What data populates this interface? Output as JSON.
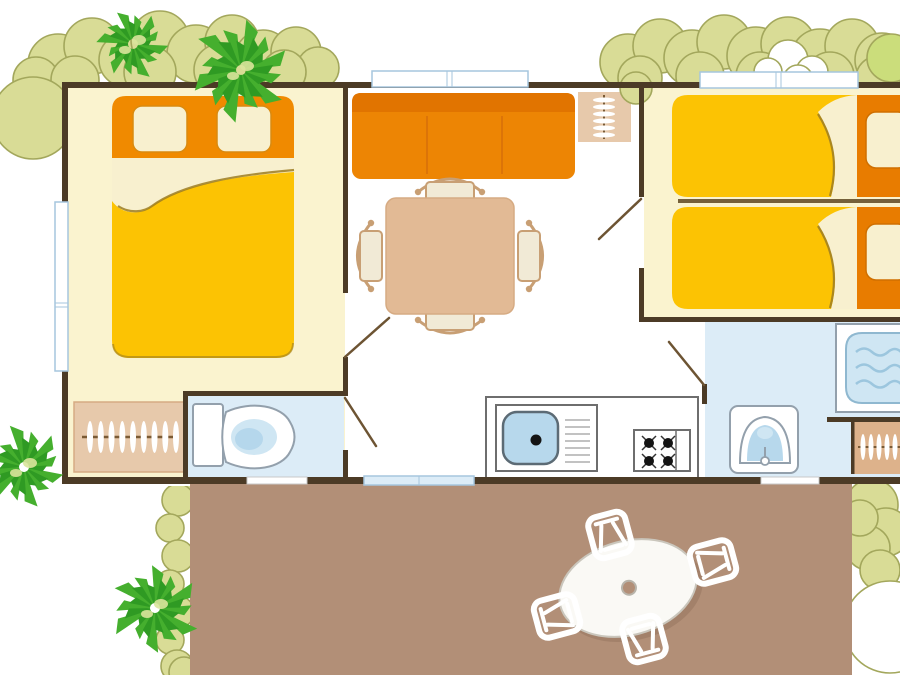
{
  "canvas": {
    "width": 900,
    "height": 675
  },
  "plan": {
    "type": "mobile-home-floorplan",
    "rooms": [
      "bedroom-double",
      "living-kitchen",
      "bedroom-twin",
      "wc",
      "bathroom",
      "terrace"
    ],
    "furniture": [
      "double-bed",
      "wardrobe-hangers",
      "toilet",
      "sofa",
      "coat-rack",
      "dining-table-4-chairs",
      "kitchen-sink",
      "stove-4-burners",
      "single-bed",
      "single-bed",
      "washbasin",
      "shower",
      "wardrobe-hangers",
      "terrace-oval-table",
      "terrace-chair",
      "terrace-chair",
      "terrace-chair",
      "terrace-chair"
    ],
    "windows": 3,
    "doors": 4,
    "vegetation": [
      "bush-top-left",
      "bush-top-right",
      "bush-left-circle",
      "bush-terrace-left",
      "bush-terrace-right",
      "palm-top-left-small",
      "palm-top-left-big",
      "palm-bottom-left",
      "palm-bottom"
    ]
  },
  "palette": {
    "wall": "#4c3b26",
    "door_leaf": "#6d5433",
    "room_cream": "#faf3cf",
    "wet_blue": "#dcecf7",
    "floor_white": "#ffffff",
    "terrace": "#b28f77",
    "bed_yellow": "#fcc303",
    "headboard_orange": "#f08a00",
    "headboard_orange_dark": "#e87c00",
    "pillow_stroke": "#d98a10",
    "fold_cream": "#f8f0cf",
    "fold_shadow": "#9c7d22",
    "sofa": "#ed8504",
    "sofa_back": "#e17400",
    "sofa_seam": "#d8700a",
    "wood_tan": "#e2ba95",
    "wood_tan_edge": "#d6ab83",
    "wood_light": "#e7c9ab",
    "wardrobe_tan": "#ddb28b",
    "rail_brown": "#7a5a34",
    "chair_seat": "#f1ead6",
    "chair_wood": "#c89f74",
    "fixture_stroke": "#93a0ac",
    "water_blue": "#b7d8ec",
    "water_light": "#cfe6f3",
    "water_deep": "#a9d0e8",
    "wave": "#9cc6de",
    "counter_stroke": "#6e6e6e",
    "burner": "#141414",
    "drainer": "#c2c2c2",
    "window_stroke": "#a6c6de",
    "threshold_stroke": "#c9c9c9",
    "divider": "#75603a",
    "bush_fill": "#d9dc96",
    "bush_stroke": "#a3a75c",
    "bush_light": "#cbdd7b",
    "palm_dark": "#2f9a23",
    "palm_mid": "#45af2e",
    "palm_light": "#d9e49b",
    "terrace_table": "#faf9f5",
    "table_stroke": "#cac6bc",
    "white": "#ffffff"
  },
  "decorations": {
    "bushes": [
      {
        "name": "bush-top-left",
        "layer": "behind",
        "circles": [
          [
            58,
            64,
            30
          ],
          [
            92,
            46,
            28
          ],
          [
            126,
            60,
            27
          ],
          [
            160,
            40,
            29
          ],
          [
            196,
            54,
            29
          ],
          [
            232,
            42,
            27
          ],
          [
            263,
            58,
            28
          ],
          [
            296,
            52,
            25
          ],
          [
            318,
            68,
            21
          ],
          [
            36,
            80,
            23
          ],
          [
            75,
            80,
            24
          ],
          [
            150,
            72,
            26
          ],
          [
            220,
            70,
            26
          ],
          [
            284,
            72,
            22
          ]
        ]
      },
      {
        "name": "bush-top-right",
        "layer": "behind",
        "circles": [
          [
            628,
            62,
            28
          ],
          [
            660,
            46,
            27
          ],
          [
            692,
            58,
            28
          ],
          [
            724,
            42,
            27
          ],
          [
            756,
            56,
            29
          ],
          [
            788,
            44,
            27
          ],
          [
            820,
            58,
            29
          ],
          [
            852,
            46,
            27
          ],
          [
            882,
            60,
            27
          ],
          [
            640,
            78,
            22
          ],
          [
            700,
            76,
            24
          ],
          [
            760,
            76,
            24
          ],
          [
            830,
            76,
            24
          ],
          [
            878,
            78,
            22
          ]
        ]
      },
      {
        "name": "bush-light-blob",
        "layer": "behind",
        "fill": "light",
        "circles": [
          [
            891,
            58,
            24
          ]
        ]
      },
      {
        "name": "bush-white-cloud",
        "layer": "behind",
        "fill": "white",
        "circles": [
          [
            788,
            60,
            20
          ],
          [
            812,
            72,
            16
          ],
          [
            768,
            72,
            14
          ],
          [
            798,
            80,
            15
          ]
        ]
      },
      {
        "name": "bush-left-circle",
        "layer": "behind",
        "circles": [
          [
            33,
            118,
            41
          ]
        ]
      },
      {
        "name": "bush-terrace-left",
        "layer": "terrace",
        "clip": "clipL",
        "circles": [
          [
            184,
            489,
            15
          ],
          [
            178,
            500,
            16
          ],
          [
            170,
            528,
            14
          ],
          [
            178,
            556,
            16
          ],
          [
            170,
            584,
            14
          ],
          [
            178,
            612,
            16
          ],
          [
            170,
            640,
            14
          ],
          [
            177,
            666,
            16
          ],
          [
            184,
            672,
            15
          ]
        ]
      },
      {
        "name": "bush-terrace-right",
        "layer": "terrace",
        "clip": "clipR",
        "circles": [
          [
            872,
            505,
            26
          ],
          [
            886,
            532,
            24
          ],
          [
            868,
            548,
            22
          ],
          [
            880,
            570,
            20
          ],
          [
            860,
            518,
            18
          ]
        ]
      },
      {
        "name": "bush-terrace-right-cutout",
        "layer": "terrace",
        "clip": "clipR",
        "fill": "white",
        "circles": [
          [
            890,
            627,
            46
          ]
        ]
      },
      {
        "name": "bush-wedge",
        "layer": "overlay",
        "circles": [
          [
            636,
            88,
            16
          ]
        ]
      }
    ],
    "palms": [
      {
        "name": "palm-top-left-small",
        "cx": 133,
        "cy": 44,
        "s": 0.8,
        "rot": 12
      },
      {
        "name": "palm-top-left-big",
        "cx": 241,
        "cy": 70,
        "s": 1.15,
        "rot": 45
      },
      {
        "name": "palm-bottom-left",
        "cx": 24,
        "cy": 467,
        "s": 0.95,
        "rot": 80
      },
      {
        "name": "palm-bottom",
        "cx": 155,
        "cy": 608,
        "s": 1.02,
        "rot": -25
      }
    ],
    "palm_radii": [
      44,
      36,
      46,
      38,
      44,
      34,
      46,
      38,
      44,
      36,
      42,
      35
    ]
  }
}
